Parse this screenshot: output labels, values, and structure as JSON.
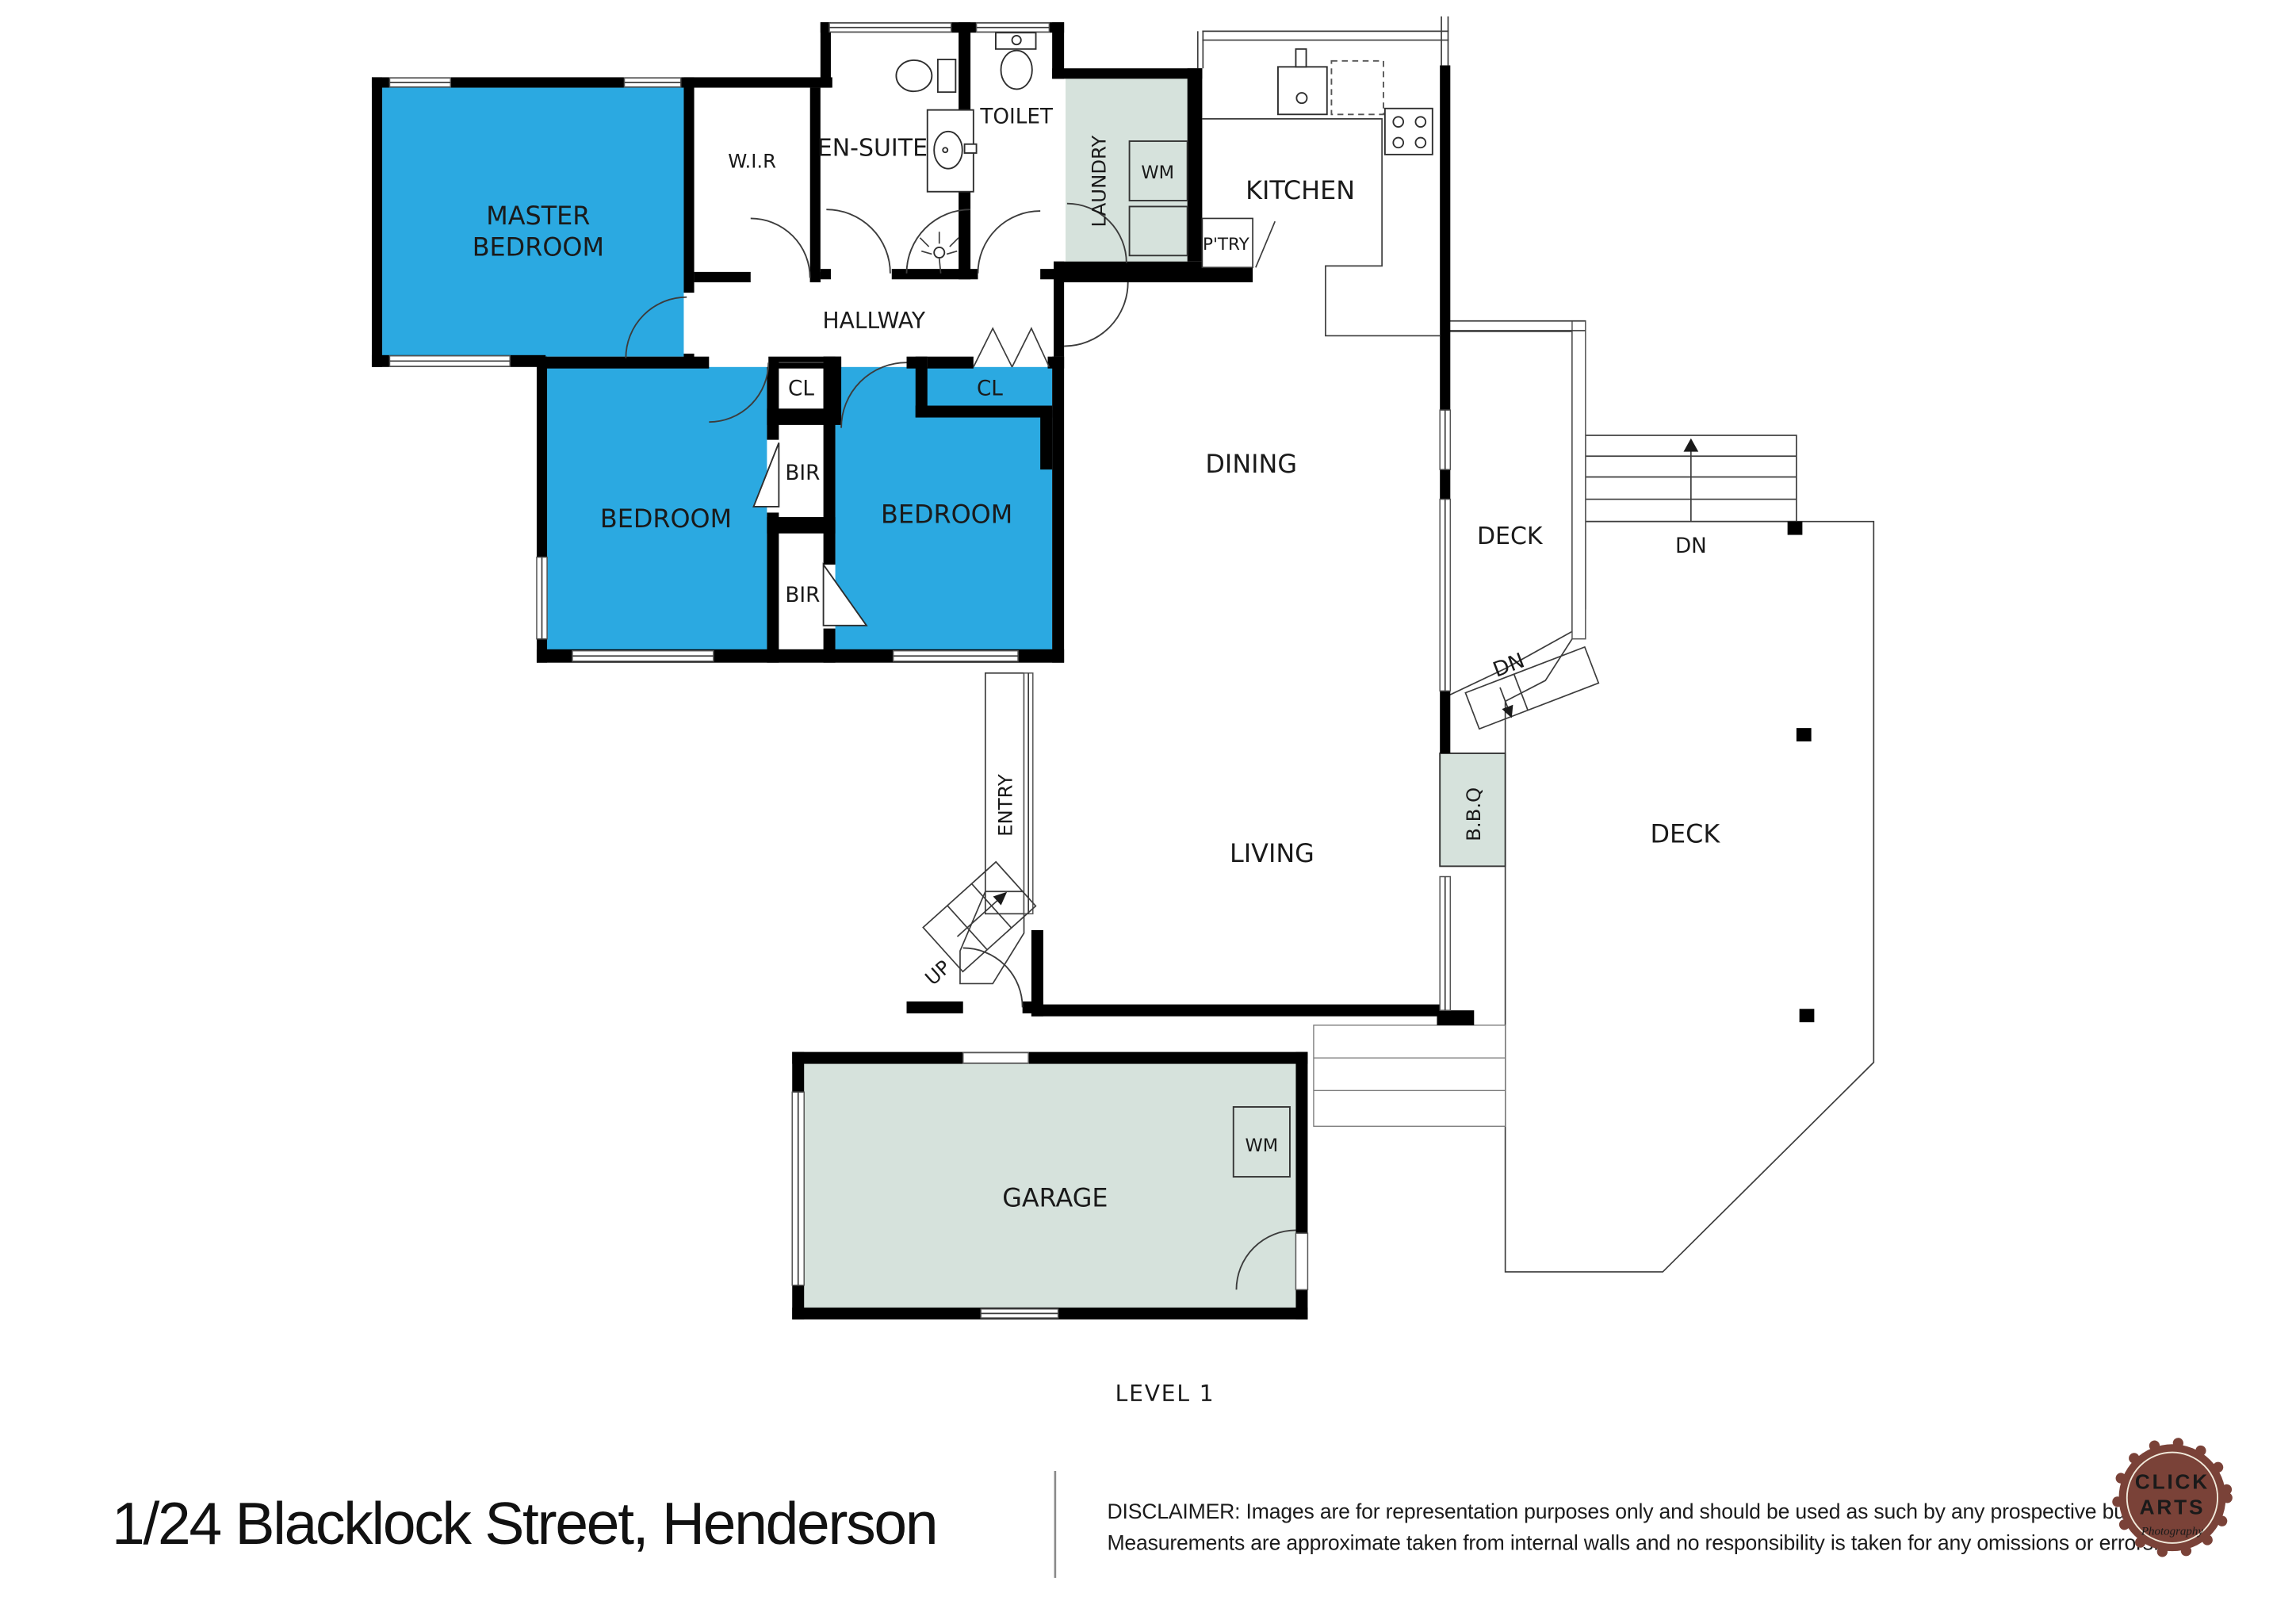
{
  "plan": {
    "level_label": "LEVEL 1",
    "labels": {
      "master_line1": "MASTER",
      "master_line2": "BEDROOM",
      "wir": "W.I.R",
      "ensuite": "EN-SUITE",
      "toilet": "TOILET",
      "laundry": "LAUNDRY",
      "wm_laundry": "WM",
      "kitchen": "KITCHEN",
      "pantry": "P'TRY",
      "hallway": "HALLWAY",
      "cl_left": "CL",
      "cl_right": "CL",
      "bir_upper": "BIR",
      "bir_lower": "BIR",
      "bedroom_left": "BEDROOM",
      "bedroom_right": "BEDROOM",
      "dining": "DINING",
      "deck_upper": "DECK",
      "dn_stairs": "DN",
      "dn_ramp": "DN",
      "entry": "ENTRY",
      "up": "UP",
      "living": "LIVING",
      "bbq": "B.B.Q",
      "deck_main": "DECK",
      "wm_garage": "WM",
      "garage": "GARAGE"
    },
    "colors": {
      "room_blue": "#2BA9E1",
      "area_green": "#D6E2DC",
      "wall": "#000000"
    }
  },
  "footer": {
    "address": "1/24 Blacklock Street, Henderson",
    "disclaimer_line1": "DISCLAIMER: Images are for representation purposes only and should be used as such by any prospective buyer.",
    "disclaimer_line2": "Measurements are approximate taken from internal walls and no responsibility is taken for any omissions or errors.",
    "logo": {
      "word1": "CLICK",
      "word2": "ARTS",
      "subtitle": "Photography",
      "color": "#7A4238",
      "text_color": "#F1EADB"
    }
  }
}
